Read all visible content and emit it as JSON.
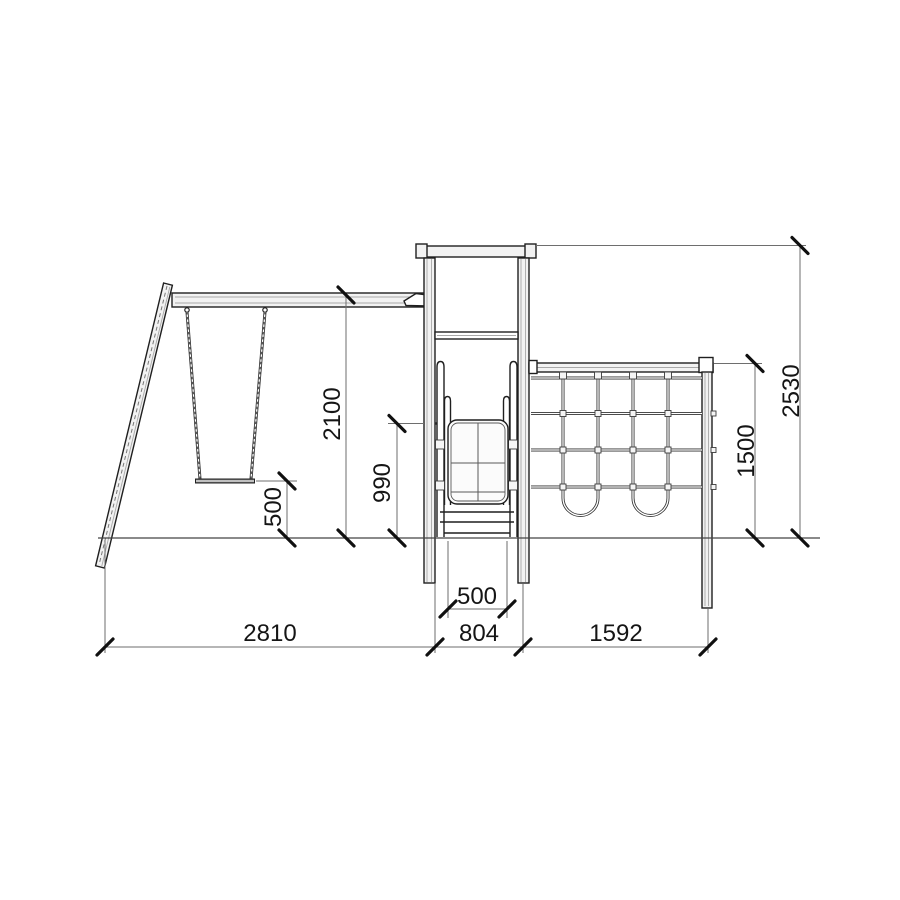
{
  "colors": {
    "paper": "#ffffff",
    "ink": "#1f1f1f",
    "dim-line": "#6e6e6e",
    "tick": "#101010",
    "label": "#151515"
  },
  "dimensions": {
    "bottom": {
      "swing_span": "2810",
      "tower_span": "804",
      "net_span": "1592"
    },
    "slide_width": "500",
    "heights": {
      "beam": "2100",
      "platform": "990",
      "seat": "500",
      "net": "1500",
      "overall": "2530"
    }
  }
}
